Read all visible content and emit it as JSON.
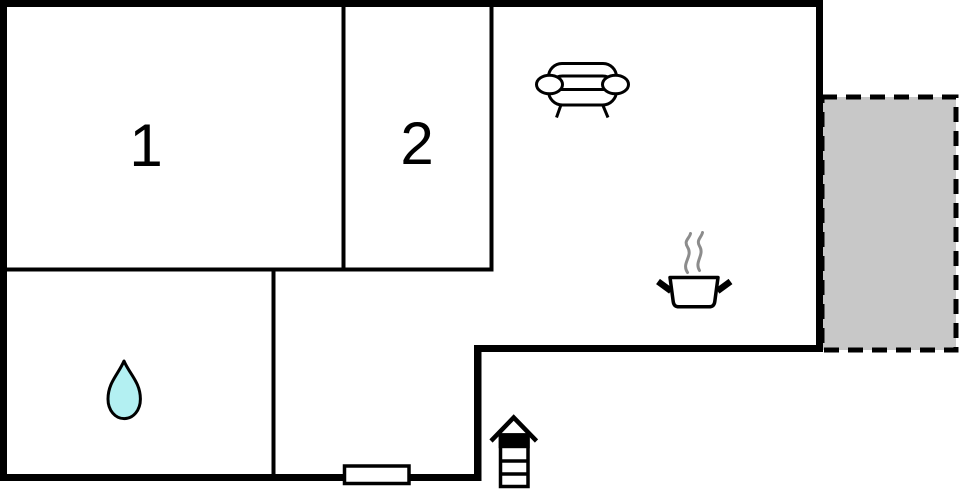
{
  "canvas": {
    "width": 960,
    "height": 490,
    "background": "#ffffff"
  },
  "colors": {
    "wall": "#000000",
    "terrace_fill": "#c8c8c8",
    "terrace_border": "#000000",
    "water_drop_fill": "#b3f0f2",
    "water_drop_stroke": "#000000",
    "steam_gray": "#8c8c8c",
    "furniture_stroke": "#000000",
    "furniture_fill": "#ffffff"
  },
  "rooms": [
    {
      "name": "bedroom-1",
      "label": "1"
    },
    {
      "name": "bedroom-2",
      "label": "2"
    }
  ],
  "icons": [
    {
      "name": "sofa-icon"
    },
    {
      "name": "cooking-pot-icon"
    },
    {
      "name": "steam-icon"
    },
    {
      "name": "water-drop-icon"
    },
    {
      "name": "ladder-icon"
    },
    {
      "name": "window-marker"
    },
    {
      "name": "terrace-area"
    }
  ]
}
